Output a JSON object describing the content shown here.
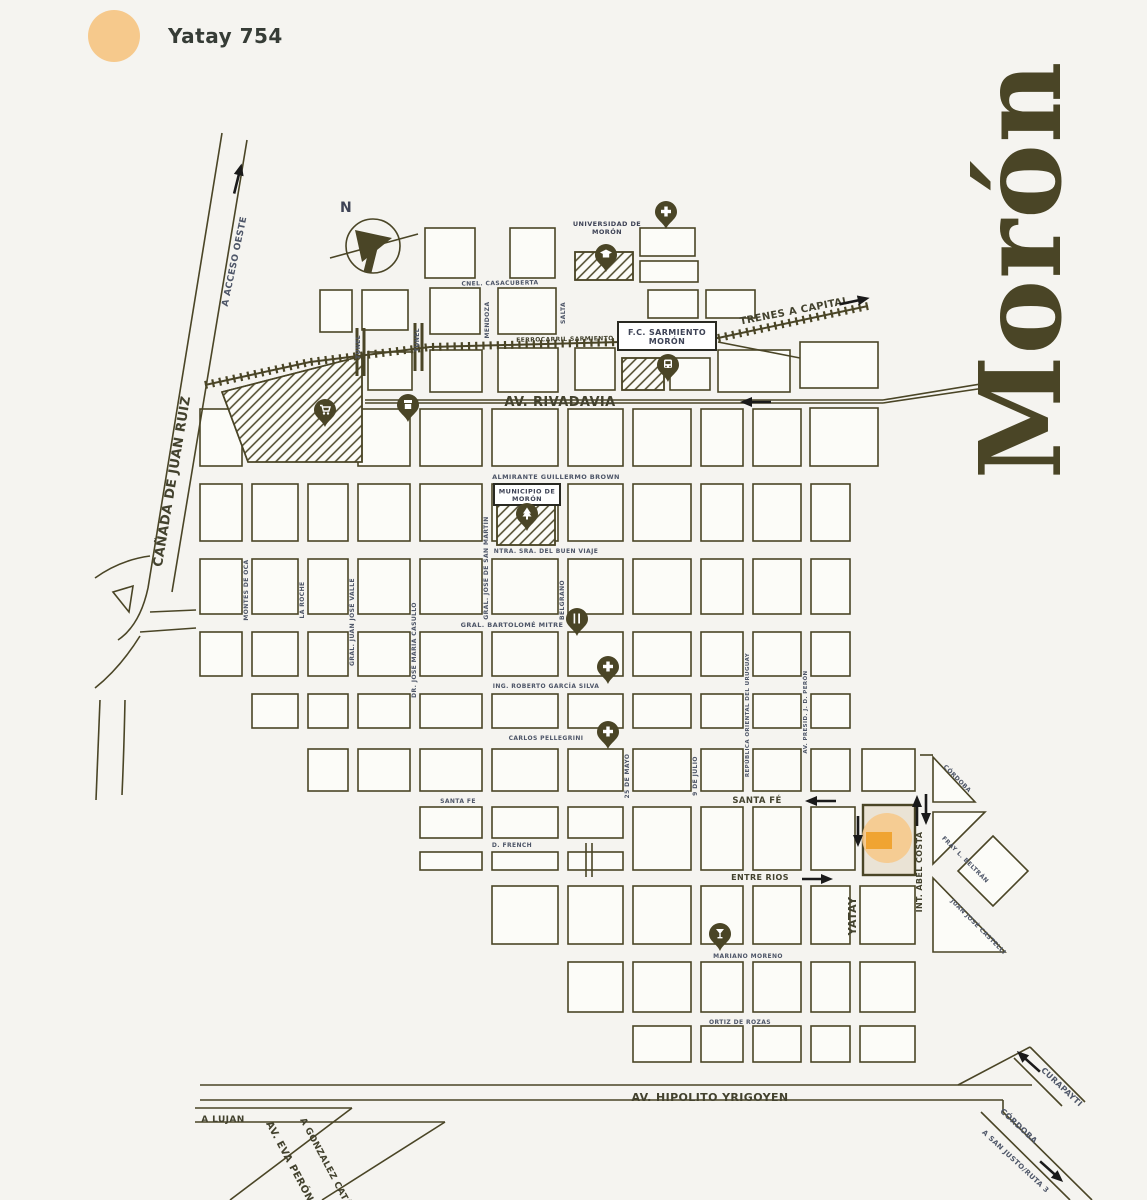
{
  "legend": {
    "label": "Yatay 754"
  },
  "title": "Morón",
  "compass": {
    "letter": "N"
  },
  "boxes": {
    "station": {
      "line1": "F.C. SARMIENTO",
      "line2": "MORÓN"
    },
    "municipio": {
      "line1": "MUNICIPIO DE",
      "line2": "MORÓN"
    },
    "universidad": {
      "line1": "UNIVERSIDAD DE",
      "line2": "MORÓN"
    }
  },
  "streets": [
    {
      "text": "CAÑADA DE JUAN RUIZ",
      "x": 176,
      "y": 482,
      "r": -80.5,
      "s": 13,
      "c": "b"
    },
    {
      "text": "A ACCESO OESTE",
      "x": 237,
      "y": 262,
      "r": -78,
      "s": 9,
      "c": "s"
    },
    {
      "text": "TRENES A CAPITAL",
      "x": 795,
      "y": 314,
      "r": -11,
      "s": 10,
      "c": "b"
    },
    {
      "text": "FERROCARRIL SARMIENTO",
      "x": 565,
      "y": 341,
      "r": -1,
      "s": 6,
      "c": "b"
    },
    {
      "text": "AV. RIVADAVIA",
      "x": 560,
      "y": 406,
      "r": 0,
      "s": 13,
      "c": "b"
    },
    {
      "text": "CNEL. CASACUBERTA",
      "x": 500,
      "y": 285,
      "r": -1,
      "s": 6,
      "c": "s"
    },
    {
      "text": "MENDOZA",
      "x": 489,
      "y": 320,
      "r": -90,
      "s": 6,
      "c": "s"
    },
    {
      "text": "SALTA",
      "x": 565,
      "y": 313,
      "r": -90,
      "s": 6,
      "c": "s"
    },
    {
      "text": "TUNEL",
      "x": 360,
      "y": 347,
      "r": -90,
      "s": 6,
      "c": "s"
    },
    {
      "text": "TUNEL",
      "x": 419,
      "y": 340,
      "r": -90,
      "s": 6,
      "c": "s"
    },
    {
      "text": "ALMIRANTE GUILLERMO BROWN",
      "x": 556,
      "y": 479,
      "r": 0,
      "s": 6.5,
      "c": "s"
    },
    {
      "text": "NTRA. SRA. DEL BUEN VIAJE",
      "x": 546,
      "y": 553,
      "r": 0,
      "s": 6,
      "c": "s"
    },
    {
      "text": "GRAL. BARTOLOMÉ MITRE",
      "x": 512,
      "y": 627,
      "r": 0,
      "s": 6.5,
      "c": "s"
    },
    {
      "text": "ING. ROBERTO GARCÍA SILVA",
      "x": 546,
      "y": 688,
      "r": 0,
      "s": 6,
      "c": "s"
    },
    {
      "text": "CARLOS PELLEGRINI",
      "x": 546,
      "y": 740,
      "r": 0,
      "s": 6,
      "c": "s"
    },
    {
      "text": "SANTA FE",
      "x": 458,
      "y": 803,
      "r": 0,
      "s": 6,
      "c": "s"
    },
    {
      "text": "SANTA FÉ",
      "x": 757,
      "y": 803,
      "r": 0,
      "s": 8.5,
      "c": "b"
    },
    {
      "text": "D. FRENCH",
      "x": 512,
      "y": 847,
      "r": 0,
      "s": 6,
      "c": "s"
    },
    {
      "text": "ENTRE RIOS",
      "x": 760,
      "y": 880,
      "r": 0,
      "s": 8,
      "c": "b"
    },
    {
      "text": "MARIANO MORENO",
      "x": 748,
      "y": 958,
      "r": 0,
      "s": 6,
      "c": "s"
    },
    {
      "text": "ORTIZ DE ROZAS",
      "x": 740,
      "y": 1024,
      "r": 0,
      "s": 6,
      "c": "s"
    },
    {
      "text": "AV. HIPOLITO YRIGOYEN",
      "x": 710,
      "y": 1101,
      "r": 0,
      "s": 11,
      "c": "b"
    },
    {
      "text": "A LUJAN",
      "x": 223,
      "y": 1122,
      "r": 0,
      "s": 9,
      "c": "b"
    },
    {
      "text": "AV. EVA PERÓN",
      "x": 287,
      "y": 1163,
      "r": 62,
      "s": 10,
      "c": "b"
    },
    {
      "text": "A GONZALEZ CATÁN",
      "x": 325,
      "y": 1167,
      "r": 62,
      "s": 9,
      "c": "b"
    },
    {
      "text": "CURAPAYTI",
      "x": 1060,
      "y": 1089,
      "r": 43,
      "s": 8,
      "c": "s"
    },
    {
      "text": "CÓRDOBA",
      "x": 1017,
      "y": 1128,
      "r": 43,
      "s": 8,
      "c": "s"
    },
    {
      "text": "A SAN JUSTO/RUTA 3",
      "x": 1014,
      "y": 1163,
      "r": 43,
      "s": 7,
      "c": "s"
    },
    {
      "text": "CÓRDOBA",
      "x": 956,
      "y": 780,
      "r": 45,
      "s": 6,
      "c": "s"
    },
    {
      "text": "FRAY L. BELTRÁN",
      "x": 964,
      "y": 861,
      "r": 45,
      "s": 6,
      "c": "s"
    },
    {
      "text": "JUAN JOSÉ CASTELLI",
      "x": 977,
      "y": 928,
      "r": 45,
      "s": 6,
      "c": "s"
    },
    {
      "text": "YATAY",
      "x": 856,
      "y": 916,
      "r": -90,
      "s": 11,
      "c": "b"
    },
    {
      "text": "INT. ABEL COSTA",
      "x": 922,
      "y": 872,
      "r": -90,
      "s": 8,
      "c": "b"
    },
    {
      "text": "MONTES DE OCA",
      "x": 248,
      "y": 590,
      "r": -90,
      "s": 6,
      "c": "s"
    },
    {
      "text": "LA ROCHE",
      "x": 304,
      "y": 600,
      "r": -90,
      "s": 6,
      "c": "s"
    },
    {
      "text": "GRAL. JUAN JOSÉ VALLE",
      "x": 354,
      "y": 622,
      "r": -90,
      "s": 6,
      "c": "s"
    },
    {
      "text": "DR. JOSÉ MARÍA CASULLO",
      "x": 416,
      "y": 650,
      "r": -90,
      "s": 6,
      "c": "s"
    },
    {
      "text": "GRAL. JOSÉ DE SAN MARTÍN",
      "x": 488,
      "y": 568,
      "r": -90,
      "s": 6,
      "c": "s"
    },
    {
      "text": "BELGRANO",
      "x": 564,
      "y": 600,
      "r": -90,
      "s": 6,
      "c": "s"
    },
    {
      "text": "25 DE MAYO",
      "x": 629,
      "y": 776,
      "r": -90,
      "s": 6,
      "c": "s"
    },
    {
      "text": "9 DE JULIO",
      "x": 697,
      "y": 776,
      "r": -90,
      "s": 6,
      "c": "s"
    },
    {
      "text": "REPÚBLICA ORIENTAL DEL URUGUAY",
      "x": 749,
      "y": 715,
      "r": -90,
      "s": 5.5,
      "c": "s"
    },
    {
      "text": "AV. PRESID. J. D. PERÓN",
      "x": 807,
      "y": 712,
      "r": -90,
      "s": 5.5,
      "c": "s"
    }
  ],
  "pois": [
    {
      "icon": "cross",
      "x": 666,
      "y": 213
    },
    {
      "icon": "university",
      "x": 606,
      "y": 256
    },
    {
      "icon": "cart",
      "x": 325,
      "y": 411
    },
    {
      "icon": "shop",
      "x": 408,
      "y": 406
    },
    {
      "icon": "train",
      "x": 668,
      "y": 366
    },
    {
      "icon": "tree",
      "x": 527,
      "y": 515
    },
    {
      "icon": "restaurant",
      "x": 577,
      "y": 620
    },
    {
      "icon": "cross",
      "x": 608,
      "y": 668
    },
    {
      "icon": "cross",
      "x": 608,
      "y": 733
    },
    {
      "icon": "bar",
      "x": 720,
      "y": 935
    }
  ],
  "arrows": [
    {
      "name": "rivadavia-oneway",
      "x": 755,
      "y": 402,
      "a": 180
    },
    {
      "name": "santafe-oneway",
      "x": 820,
      "y": 801,
      "a": 180
    },
    {
      "name": "entrerios-oneway",
      "x": 818,
      "y": 879,
      "a": 0
    },
    {
      "name": "yatay-oneway",
      "x": 858,
      "y": 832,
      "a": 90
    },
    {
      "name": "abelcosta-up",
      "x": 917,
      "y": 810,
      "a": -90
    },
    {
      "name": "abelcosta-down",
      "x": 926,
      "y": 810,
      "a": 90
    },
    {
      "name": "acceso-oeste",
      "x": 238,
      "y": 178,
      "a": -76
    },
    {
      "name": "trenes-capital",
      "x": 855,
      "y": 301,
      "a": -12
    },
    {
      "name": "curapayti",
      "x": 1028,
      "y": 1061,
      "a": -138
    },
    {
      "name": "sanjusto",
      "x": 1052,
      "y": 1172,
      "a": 42
    }
  ],
  "marker": {
    "circle_color": "#f6c98c",
    "rect_color": "#f0a432",
    "block_fill": "#eae3d5"
  },
  "colors": {
    "background": "#f5f4f0",
    "map_line": "#4a4526",
    "block_fill": "#fcfcf8",
    "label_small": "#4e5668",
    "label_big": "#43422e",
    "arrow": "#1a1a1a",
    "legend_dot": "#f6c98c",
    "title": "#4a4526",
    "pin": "#4a4526",
    "box_text": "#3e4356"
  }
}
